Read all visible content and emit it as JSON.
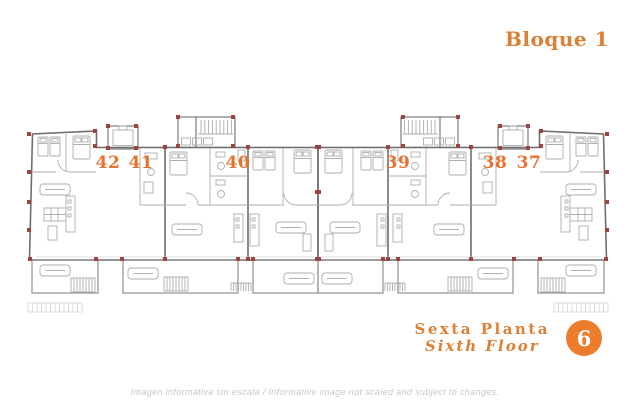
{
  "header": {
    "block_title": "Bloque 1"
  },
  "plan": {
    "units": [
      {
        "number": "42"
      },
      {
        "number": "41"
      },
      {
        "number": "40"
      },
      {
        "number": "39"
      },
      {
        "number": "38"
      },
      {
        "number": "37"
      }
    ]
  },
  "footer": {
    "floor_name_es": "Sexta Planta",
    "floor_name_en": "Sixth Floor",
    "floor_number": "6"
  },
  "disclaimer": "Imagen informativa sin escala /  Informative image not scaled and subject to changes.",
  "colors": {
    "accent_orange": "#D98136",
    "unit_number_orange": "#E8722C",
    "badge_orange": "#EC7D2C",
    "wall_gray": "#6e6e6e",
    "furniture_gray": "#aeaeae",
    "column_red": "#9C4343",
    "disclaimer_gray": "#c7c7c7"
  }
}
